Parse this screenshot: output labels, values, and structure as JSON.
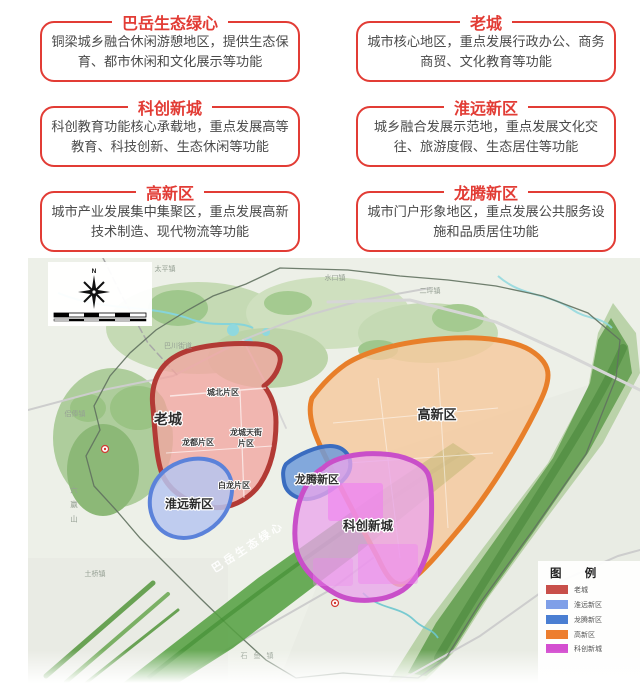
{
  "page": {
    "background": "#ffffff",
    "accent_red": "#e23c35"
  },
  "callouts": [
    {
      "title": "巴岳生态绿心",
      "body": "铜梁城乡融合休闲游憩地区，提供生态保育、都市休闲和文化展示等功能"
    },
    {
      "title": "老城",
      "body": "城市核心地区，重点发展行政办公、商务商贸、文化教育等功能"
    },
    {
      "title": "科创新城",
      "body": "科创教育功能核心承载地，重点发展高等教育、科技创新、生态休闲等功能"
    },
    {
      "title": "淮远新区",
      "body": "城乡融合发展示范地，重点发展文化交往、旅游度假、生态居住等功能"
    },
    {
      "title": "高新区",
      "body": "城市产业发展集中集聚区，重点发展高新技术制造、现代物流等功能"
    },
    {
      "title": "龙腾新区",
      "body": "城市门户形象地区，重点发展公共服务设施和品质居住功能"
    }
  ],
  "map": {
    "compass": {
      "north_label": "N"
    },
    "regions": {
      "laocheng": {
        "label": "老城",
        "fill": "#f2a5a0",
        "stroke": "#b23a35"
      },
      "gaoxinqu": {
        "label": "高新区",
        "fill": "#f5c89b",
        "stroke": "#e87f2a"
      },
      "longteng": {
        "label": "龙腾新区",
        "fill": "#6f9bd9",
        "stroke": "#3a6cc0"
      },
      "huaiyuan": {
        "label": "淮远新区",
        "fill": "#b6c6f0",
        "stroke": "#5b82da"
      },
      "kechuang": {
        "label": "科创新城",
        "fill": "#eaa5ec",
        "stroke": "#c94fc9"
      },
      "green_belt": {
        "label": "巴岳生态绿心",
        "fill": "#57a043"
      }
    },
    "sub_districts": {
      "chengbei": "城北片区",
      "longdu": "龙都片区",
      "longcheng_1": "龙城天街",
      "longcheng_2": "片区",
      "bailong": "白龙片区"
    },
    "base_labels": {
      "taiping": "太平镇",
      "shuikou": "水口镇",
      "erping": "二坪镇",
      "bachuan": "巴川街道",
      "lvfeng": "侣俸镇",
      "liuying_shan": "六赢山",
      "tuqiao": "土桥镇",
      "shiyu": "石鱼镇"
    },
    "legend": {
      "title": "图 例",
      "items": [
        {
          "label": "老城",
          "color": "#c84f4a"
        },
        {
          "label": "淮远新区",
          "color": "#7f9fe8"
        },
        {
          "label": "龙腾新区",
          "color": "#4a7ed2"
        },
        {
          "label": "高新区",
          "color": "#ed7e2f"
        },
        {
          "label": "科创新城",
          "color": "#d44fd0"
        }
      ]
    }
  }
}
